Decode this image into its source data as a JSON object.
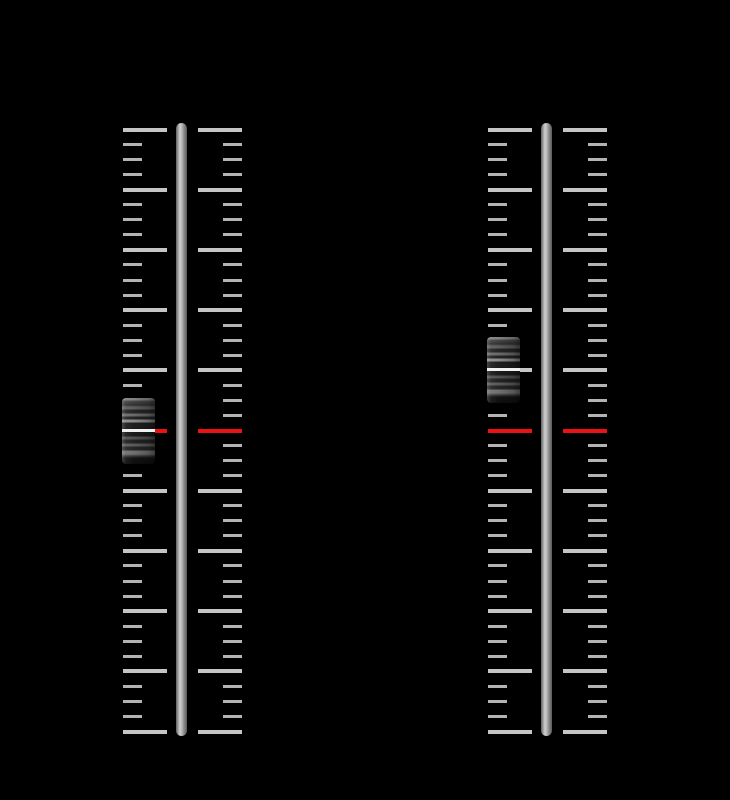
{
  "app": {
    "background": "#000000",
    "description": "Two vertical fader sliders with tick scales on black background"
  },
  "scale": {
    "min": 0,
    "max": 40,
    "ticks_total": 41,
    "major_every": 4,
    "center_mark_value": 20,
    "colors": {
      "minor_tick": "#b3b3b3",
      "major_tick": "#c5c5c5",
      "center_mark": "#ee1111",
      "track_highlight": "#cfcfcf",
      "track_shadow": "#5a5a5a",
      "cap_grip_line": "#f0f0f0",
      "background": "#000000"
    }
  },
  "faders": [
    {
      "name": "fader-left",
      "value": 20,
      "percent": 50,
      "at_center_mark": true
    },
    {
      "name": "fader-right",
      "value": 24,
      "percent": 60,
      "at_center_mark": false
    }
  ]
}
